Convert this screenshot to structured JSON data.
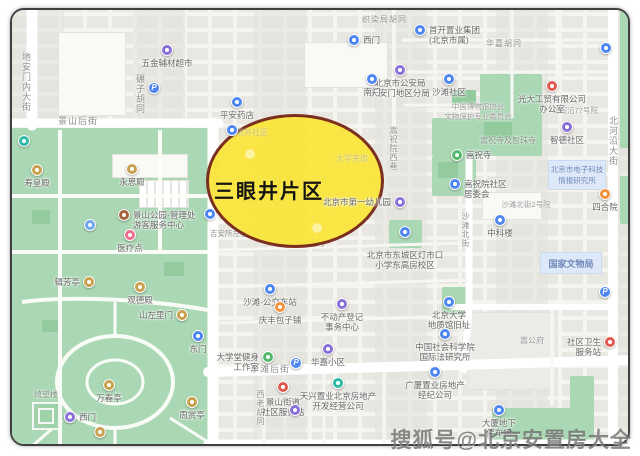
{
  "region": {
    "label": "三眼井片区"
  },
  "watermark": {
    "text": "搜狐号@北京安置房大全"
  },
  "colors": {
    "highlight_fill": "#FAE437",
    "highlight_border": "#7B2F1E",
    "park_green": "#ABD8B4",
    "road_white": "#FFFFFF",
    "gov_block_bg": "#DDE9F8",
    "gov_block_text": "#7188BB"
  },
  "icons": {
    "parking": "P"
  },
  "streets": {
    "dianmennei": "地安门内大街",
    "jingshanhou": "景山后街",
    "nianzi": "碾子胡同",
    "jingshandong": "景山东街",
    "zhiranju": "织染局胡同",
    "songzhuyuanxi": "嵩祝院西巷",
    "huajia": "华嘉胡同",
    "beiheyan": "北河沿大街",
    "shatanbei": "沙滩北街",
    "shatanhou": "沙滩后街",
    "xilao": "西老胡同",
    "sanyanjing": "三眼井胡同",
    "jiansuozuo": "吉安所左巷"
  },
  "areas": {
    "temples": "嵩祝寺及智珠寺",
    "etech": "北京市电子科技\n情报研究所",
    "wenwuju": "国家文物局",
    "shatan2yuan": "沙滩北街2号院",
    "beiheyan77": "北河沿77号院",
    "songgongfu": "嵩公府",
    "museum_assoc": "中国博物馆协会\n文物保护专业委员会",
    "faint_community": "三眼井社区",
    "faint_daxuejiadao": "大学夹道"
  },
  "pois": {
    "wujin": {
      "label": "五金辅材超市"
    },
    "yaodian": {
      "label": "平安药店"
    },
    "ximen_school": {
      "label": "西门"
    },
    "shoukai": {
      "label": "首开置业集团\n(北京市属)"
    },
    "gongan": {
      "label": "北京市公安局\n天安门地区分局"
    },
    "nanmen": {
      "label": "南门"
    },
    "shatan_shequ": {
      "label": "沙滩社区"
    },
    "guangda": {
      "label": "光大工贸有限公司\n办公室"
    },
    "zhide": {
      "label": "智德社区"
    },
    "songzhusi": {
      "label": "嵩祝寺"
    },
    "songzhuyuan_shequ": {
      "label": "嵩祝院社区\n居委会"
    },
    "zhongkelou": {
      "label": "中科楼"
    },
    "siheyuan": {
      "label": "四合院"
    },
    "youeryuan": {
      "label": "北京市第一幼儿园"
    },
    "dengshikou": {
      "label": "北京市东城区灯市口\n小学东高房校区"
    },
    "bus_shatan": {
      "label": "沙滩-公交车站"
    },
    "qingfeng": {
      "label": "庆丰包子铺"
    },
    "budongchan": {
      "label": "不动产登记\n事务中心"
    },
    "dongmen": {
      "label": "东门"
    },
    "daxuetang": {
      "label": "大学堂健身\n工作室"
    },
    "huajiaxq": {
      "label": "华嘉小区"
    },
    "tianxing": {
      "label": "天兴置业北京房地产\n开发经营公司"
    },
    "shequzhan": {
      "label": "景山街道\n社区服务站"
    },
    "pku": {
      "label": "北京大学\n地质馆旧址"
    },
    "shekeyuan": {
      "label": "中国社会科学院\n国际法研究所"
    },
    "guangsha": {
      "label": "广厦置业房地产\n经纪公司"
    },
    "weishengzhan": {
      "label": "社区卫生\n服务站"
    },
    "tingche": {
      "label": "大厦地下\n停车场"
    },
    "shouhuangdian": {
      "label": "寿皇殿"
    },
    "yongsidian": {
      "label": "永思殿"
    },
    "guanli": {
      "label": "景山公园-管理处\n游客服务中心"
    },
    "yiliao": {
      "label": "医疗点"
    },
    "jifangting": {
      "label": "辑芳亭"
    },
    "guandedian": {
      "label": "观德殿"
    },
    "shanzuoli": {
      "label": "山左里门"
    },
    "wanchunting": {
      "label": "万春亭"
    },
    "qiwanglou": {
      "label": "绮望楼"
    },
    "ximen_park": {
      "label": "西门"
    },
    "zhoushangting": {
      "label": "周赏亭"
    }
  }
}
